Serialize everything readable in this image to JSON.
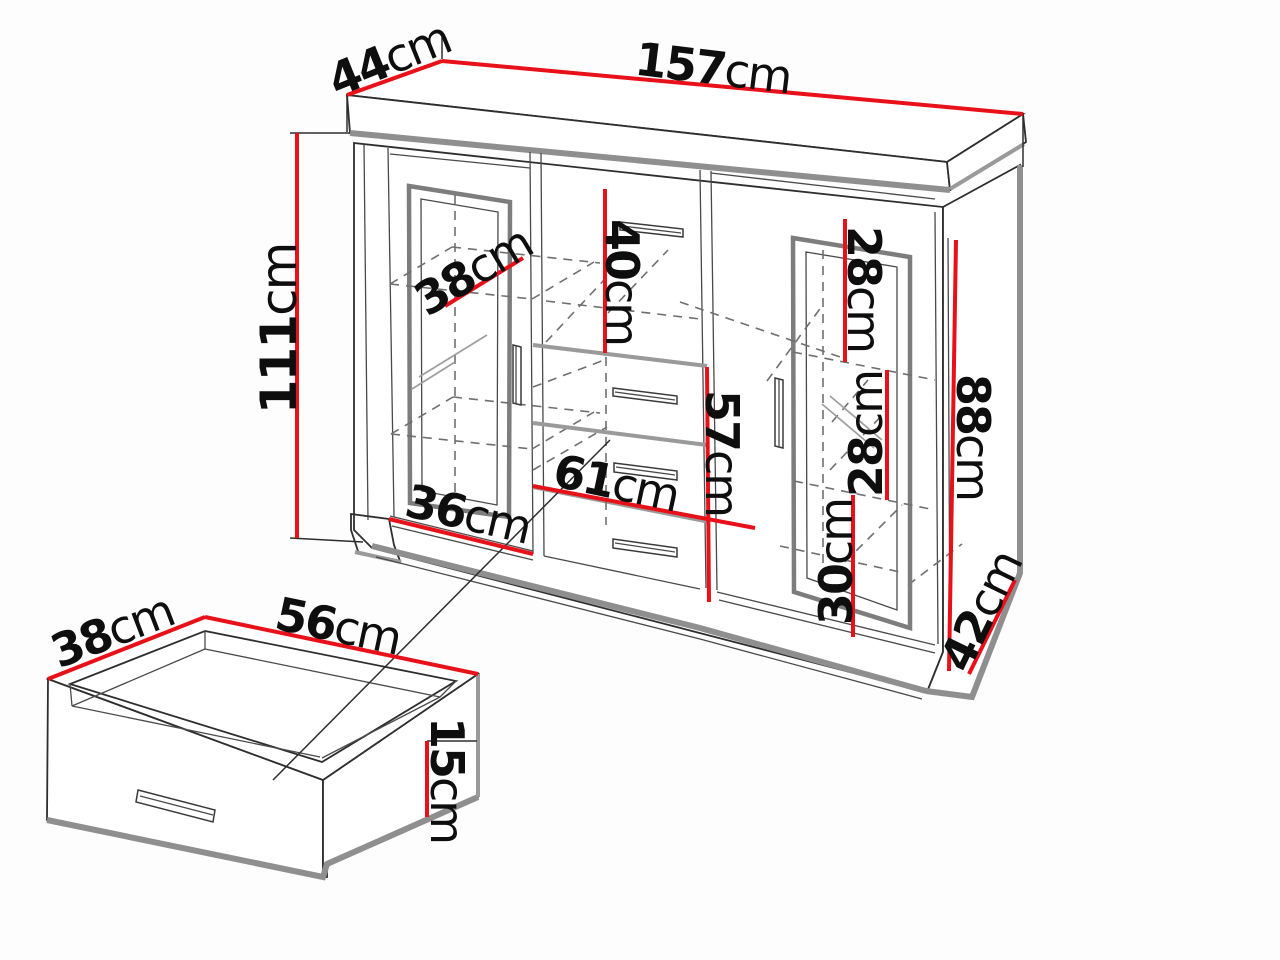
{
  "page": {
    "background": "#fdfdfd"
  },
  "diagram": {
    "kind": "furniture-dimension-diagram",
    "subject": "sideboard with drawer detail",
    "colors": {
      "dimension_line": "#e8111a",
      "outline": "#2e2e2e",
      "shadow_gray": "#8f8f8f",
      "dashed_gray": "#6f6f6f"
    },
    "cabinet": {
      "dimensions": [
        {
          "id": "top-width",
          "value": "157",
          "unit": "cm"
        },
        {
          "id": "top-depth",
          "value": "44",
          "unit": "cm"
        },
        {
          "id": "height",
          "value": "111",
          "unit": "cm"
        },
        {
          "id": "left-shelf-depth",
          "value": "38",
          "unit": "cm"
        },
        {
          "id": "top-drawer-height",
          "value": "40",
          "unit": "cm"
        },
        {
          "id": "right-top-shelf-height",
          "value": "28",
          "unit": "cm"
        },
        {
          "id": "right-side-panel-height",
          "value": "88",
          "unit": "cm"
        },
        {
          "id": "right-middle-shelf-height",
          "value": "28",
          "unit": "cm"
        },
        {
          "id": "drawer-stack-height",
          "value": "57",
          "unit": "cm"
        },
        {
          "id": "right-bottom-shelf-height",
          "value": "30",
          "unit": "cm"
        },
        {
          "id": "middle-drawer-width",
          "value": "61",
          "unit": "cm"
        },
        {
          "id": "left-door-width",
          "value": "36",
          "unit": "cm"
        },
        {
          "id": "base-side-depth",
          "value": "42",
          "unit": "cm"
        }
      ]
    },
    "drawer_detail": {
      "dimensions": [
        {
          "id": "drawer-depth",
          "value": "38",
          "unit": "cm"
        },
        {
          "id": "drawer-width",
          "value": "56",
          "unit": "cm"
        },
        {
          "id": "drawer-front-height",
          "value": "15",
          "unit": "cm"
        }
      ]
    }
  }
}
